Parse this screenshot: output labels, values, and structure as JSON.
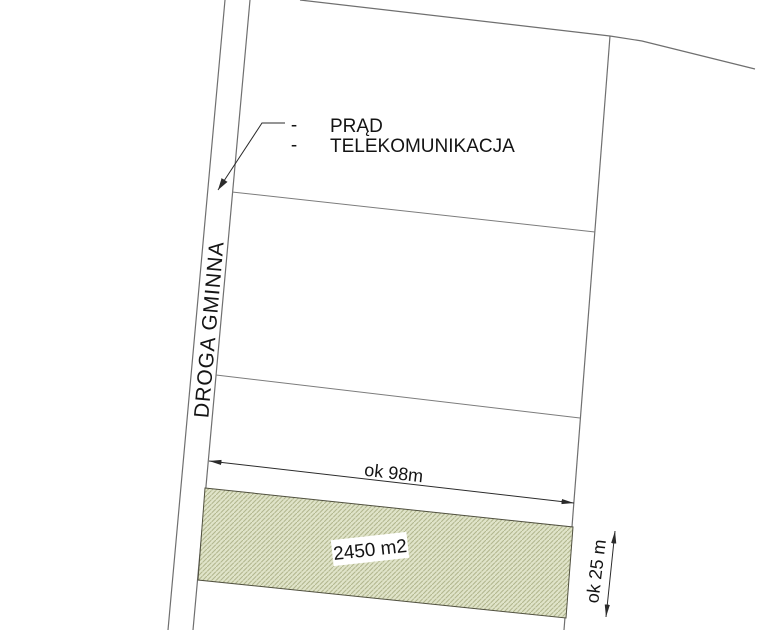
{
  "plan": {
    "road_label": "DROGA GMINNA",
    "utilities": {
      "bullet": "-",
      "items": [
        {
          "label": "PRĄD"
        },
        {
          "label": "TELEKOMUNIKACJA"
        }
      ]
    },
    "dimensions": {
      "width_label": "ok 98m",
      "depth_label": "ok 25 m"
    },
    "parcel": {
      "area_label": "2450 m2"
    },
    "colors": {
      "parcel_fill": "#e0e4c9",
      "parcel_hatch": "#b2b78f",
      "boundary_line": "#6f6f6f",
      "ink": "#2b2b2b",
      "background": "#ffffff"
    }
  }
}
